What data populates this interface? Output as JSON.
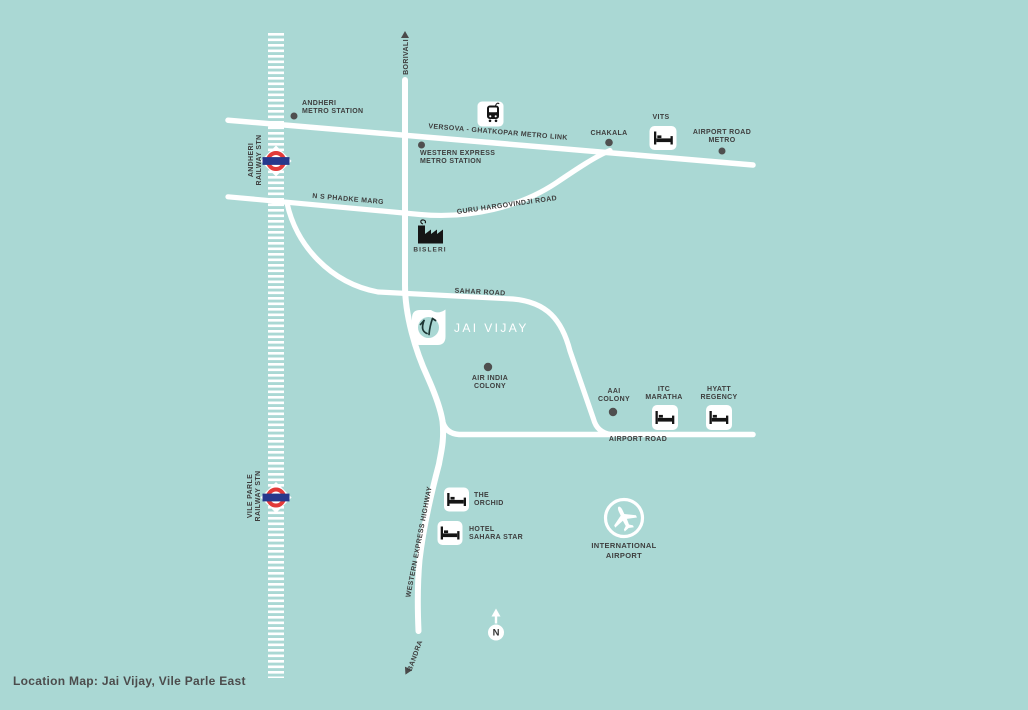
{
  "caption": "Location Map: Jai Vijay, Vile Parle East",
  "project": {
    "name": "JAI VIJAY"
  },
  "compass": {
    "label": "N"
  },
  "endpoints": {
    "north": "BORIVALI",
    "south": "BANDRA"
  },
  "colors": {
    "background": "#aad8d4",
    "road": "#ffffff",
    "label_text": "#3e3e3e",
    "roundel_red": "#e23a39",
    "roundel_blue": "#26388c",
    "icon_black": "#151515",
    "station_dot_grey": "#4f4f4f"
  },
  "railway_stations": [
    {
      "line1": "ANDHERI",
      "line2": "RAILWAY STN"
    },
    {
      "line1": "VILE PARLE",
      "line2": "RAILWAY STN"
    }
  ],
  "roads": {
    "metro_link": "VERSOVA - GHATKOPAR METRO LINK",
    "phadke_marg": "N S PHADKE MARG",
    "guru_hargovindji": "GURU HARGOVINDJI ROAD",
    "sahar_road": "SAHAR ROAD",
    "airport_road": "AIRPORT ROAD",
    "western_express_highway": "WESTERN EXPRESS HIGHWAY"
  },
  "metro_stations": [
    {
      "line1": "ANDHERI",
      "line2": "METRO STATION"
    },
    {
      "line1": "WESTERN EXPRESS",
      "line2": "METRO STATION"
    },
    {
      "label": "CHAKALA"
    },
    {
      "line1": "AIRPORT ROAD",
      "line2": "METRO"
    }
  ],
  "hotels": [
    {
      "label": "VITS"
    },
    {
      "line1": "ITC",
      "line2": "MARATHA"
    },
    {
      "line1": "HYATT",
      "line2": "REGENCY"
    },
    {
      "line1": "THE",
      "line2": "ORCHID"
    },
    {
      "line1": "HOTEL",
      "line2": "SAHARA STAR"
    }
  ],
  "landmarks": {
    "factory": "BISLERI",
    "air_india_colony": {
      "line1": "AIR INDIA",
      "line2": "COLONY"
    },
    "aai_colony": {
      "line1": "AAI",
      "line2": "COLONY"
    },
    "intl_airport": {
      "line1": "INTERNATIONAL",
      "line2": "AIRPORT"
    }
  }
}
